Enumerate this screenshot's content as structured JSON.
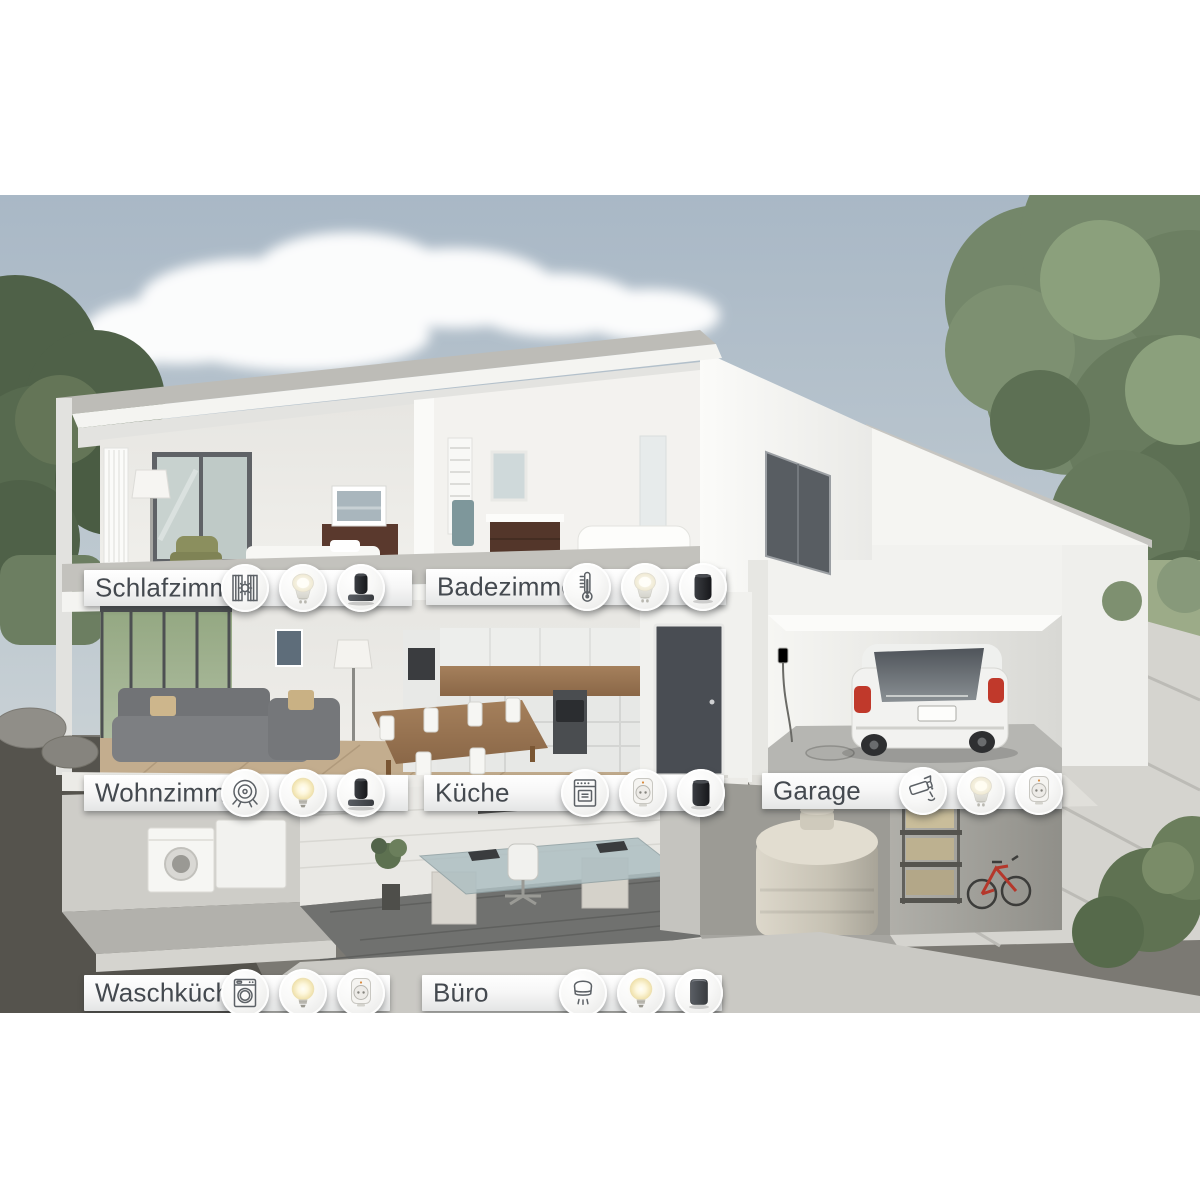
{
  "rooms": [
    {
      "label": "Schlafzimmer",
      "devices": [
        "shutter-control",
        "gu10-spot-bulb",
        "speaker-on-shelf"
      ]
    },
    {
      "label": "Badezimmer",
      "devices": [
        "radiator-thermostat",
        "gu10-spot-bulb",
        "smart-speaker-black"
      ]
    },
    {
      "label": "Wohnzimmer",
      "devices": [
        "robot-vacuum",
        "e27-smart-bulb",
        "speaker-on-shelf"
      ]
    },
    {
      "label": "Küche",
      "devices": [
        "oven",
        "smart-plug",
        "smart-speaker-black"
      ]
    },
    {
      "label": "Garage",
      "devices": [
        "security-camera",
        "gu10-spot-bulb",
        "smart-plug"
      ]
    },
    {
      "label": "Waschküche",
      "devices": [
        "washing-machine",
        "e27-smart-bulb",
        "smart-plug"
      ]
    },
    {
      "label": "Büro",
      "devices": [
        "smoke-detector",
        "e27-smart-bulb",
        "smart-speaker-grey"
      ]
    }
  ],
  "palette": {
    "sky_top": "#a9b8c6",
    "sky_bottom": "#dadedd",
    "foliage": "#74876a",
    "foliage_dark": "#4f6148",
    "wall_white": "#f4f4f1",
    "concrete": "#bdbcb7",
    "slab_white": "#f2f2ef",
    "soil": "#55534d",
    "paving": "#d5d4cf",
    "label_text": "#44494f",
    "label_bg_top": "#ffffff",
    "label_bg_bottom": "#e4e5e5",
    "icon_stroke": "#5c6166",
    "car_body": "#f2f2f0",
    "car_taillight": "#c0392b",
    "tank": "#cdc8ba",
    "wood_floor": "#c3ad8e",
    "bulb_glow": "#fdf6d8"
  }
}
